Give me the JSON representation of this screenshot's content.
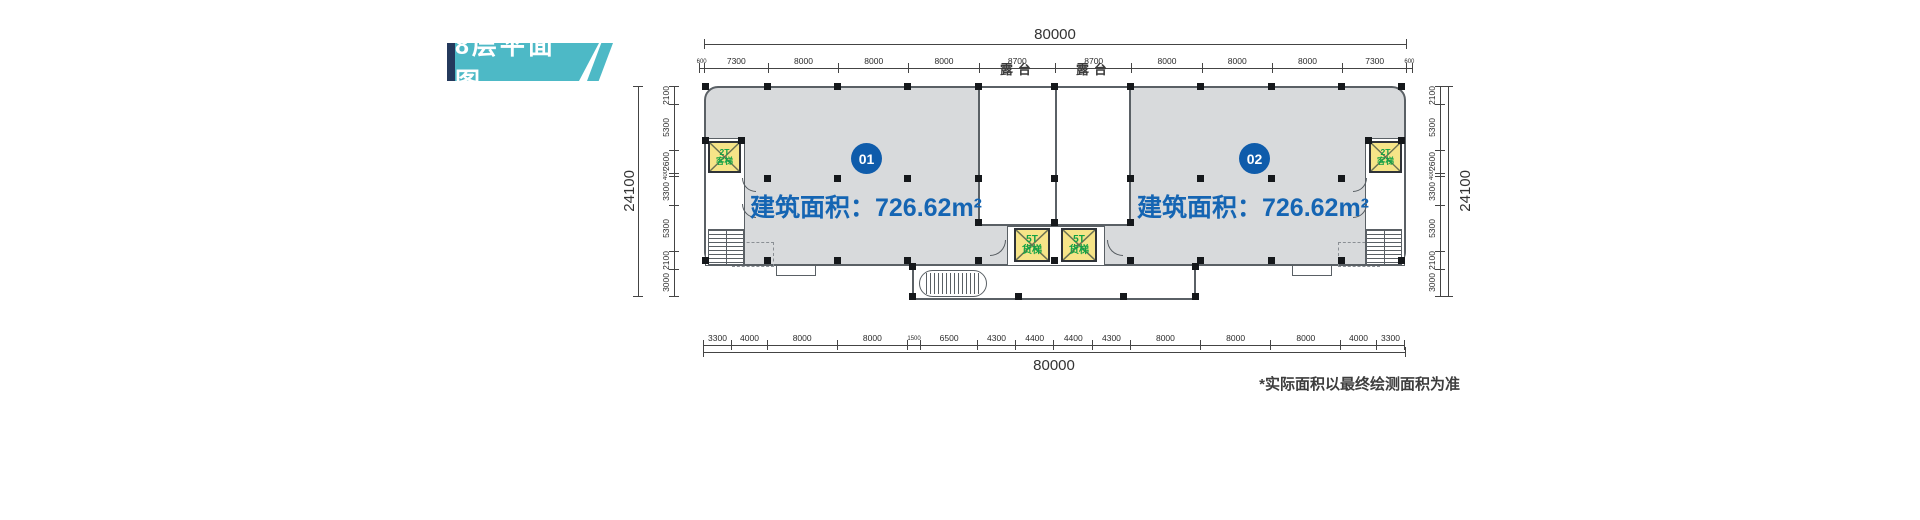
{
  "title_badge": {
    "text": "8层平面图"
  },
  "plan": {
    "units": [
      {
        "id": "01",
        "area_label": "建筑面积：726.62m²"
      },
      {
        "id": "02",
        "area_label": "建筑面积：726.62m²"
      }
    ],
    "terraces": [
      {
        "label": "露台"
      },
      {
        "label": "露台"
      }
    ],
    "freight_elevators": [
      {
        "line1": "5T",
        "line2": "货梯"
      },
      {
        "line1": "5T",
        "line2": "货梯"
      }
    ],
    "passenger_elevators": [
      {
        "line1": "2T",
        "line2": "客梯"
      },
      {
        "line1": "2T",
        "line2": "客梯"
      }
    ]
  },
  "dims": {
    "top": {
      "total": "80000",
      "segments": [
        600,
        7300,
        8000,
        8000,
        8000,
        8700,
        8700,
        8000,
        8000,
        8000,
        7300,
        600
      ]
    },
    "bottom": {
      "total": "80000",
      "segments": [
        3300,
        4000,
        8000,
        8000,
        1500,
        6500,
        4300,
        4400,
        4400,
        4300,
        8000,
        8000,
        8000,
        4000,
        3300
      ]
    },
    "left": {
      "total": "24100",
      "segments": [
        2100,
        5300,
        2600,
        400,
        3300,
        5300,
        2100,
        3000
      ]
    },
    "right": {
      "total": "24100",
      "segments": [
        2100,
        5300,
        2600,
        400,
        3300,
        5300,
        2100,
        3000
      ]
    }
  },
  "footnote": "*实际面积以最终绘测面积为准",
  "colors": {
    "badge_teal": "#4db9c6",
    "badge_navy": "#24395c",
    "accent_blue": "#1565b3",
    "plan_fill": "#d8dadc",
    "elevator_yellow": "#f6e488",
    "elevator_green": "#12a245",
    "line_dark": "#444444"
  }
}
